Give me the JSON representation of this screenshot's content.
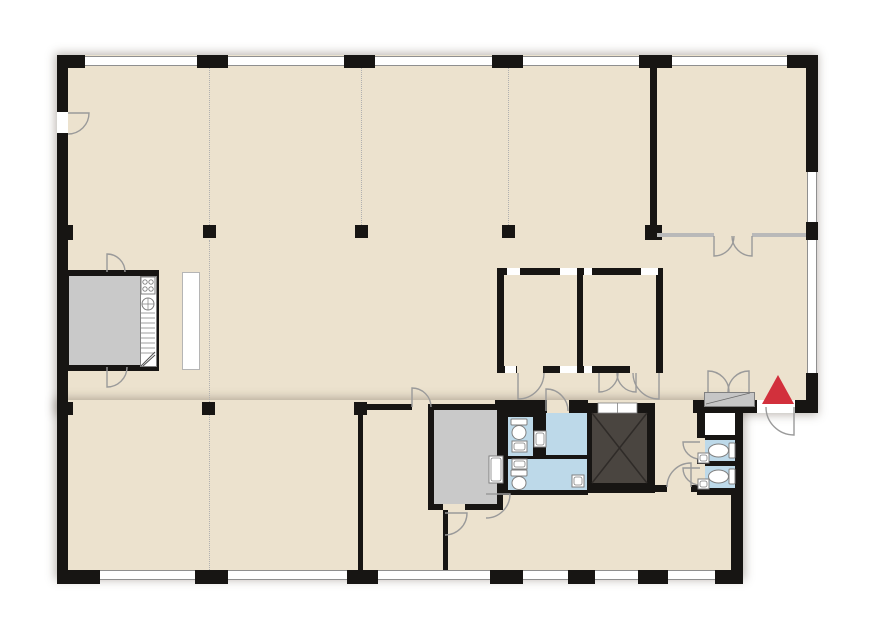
{
  "meta": {
    "description": "Office building floor plan",
    "canvas": {
      "w": 889,
      "h": 617
    }
  },
  "colors": {
    "outside": "#ffffff",
    "floor": "#ece2ce",
    "wall": "#171513",
    "window_line": "#8f8f8f",
    "wet_room": "#bdd9e9",
    "service_room": "#c9c9c9",
    "elevator_cab": "#4a4540",
    "elevator_x": "#2f2b28",
    "cabinet": "#c6c6c6",
    "door_arc": "#9a9a9a",
    "fixture_stroke": "#808080",
    "glass_partition": "#b9b9b9",
    "grid_dotted": "#b0b0b0",
    "entrance_marker": "#d2303c",
    "partition_stroke": "#b5b5b5",
    "white": "#ffffff"
  },
  "slabs": [
    {
      "name": "floor-slab-upper",
      "x": 57,
      "y": 55,
      "w": 759,
      "h": 358
    },
    {
      "name": "floor-slab-lower",
      "x": 57,
      "y": 400,
      "w": 686,
      "h": 178
    }
  ],
  "grid_lines": [
    {
      "name": "column-grid-line",
      "x": 209,
      "y": 68,
      "len": 157
    },
    {
      "name": "column-grid-line",
      "x": 209,
      "y": 240,
      "len": 162
    },
    {
      "name": "column-grid-line",
      "x": 209,
      "y": 415,
      "len": 155
    },
    {
      "name": "column-grid-line",
      "x": 361,
      "y": 68,
      "len": 157
    },
    {
      "name": "column-grid-line",
      "x": 508,
      "y": 68,
      "len": 157
    }
  ],
  "walls": [
    {
      "name": "wall-top-pier",
      "x": 57,
      "y": 55,
      "w": 28,
      "h": 13
    },
    {
      "name": "wall-top-pier",
      "x": 197,
      "y": 55,
      "w": 31,
      "h": 13
    },
    {
      "name": "wall-top-pier",
      "x": 344,
      "y": 55,
      "w": 31,
      "h": 13
    },
    {
      "name": "wall-top-pier",
      "x": 492,
      "y": 55,
      "w": 31,
      "h": 13
    },
    {
      "name": "wall-top-pier",
      "x": 639,
      "y": 55,
      "w": 33,
      "h": 13
    },
    {
      "name": "wall-top-pier",
      "x": 787,
      "y": 55,
      "w": 31,
      "h": 13
    },
    {
      "name": "wall-left",
      "x": 57,
      "y": 55,
      "w": 11,
      "h": 57
    },
    {
      "name": "wall-left",
      "x": 57,
      "y": 133,
      "w": 11,
      "h": 450
    },
    {
      "name": "wall-left-pier",
      "x": 57,
      "y": 225,
      "w": 16,
      "h": 15
    },
    {
      "name": "wall-left-pier",
      "x": 57,
      "y": 402,
      "w": 16,
      "h": 13
    },
    {
      "name": "wall-bottom-pier",
      "x": 57,
      "y": 570,
      "w": 43,
      "h": 14
    },
    {
      "name": "wall-bottom-pier",
      "x": 195,
      "y": 570,
      "w": 33,
      "h": 14
    },
    {
      "name": "wall-bottom-pier",
      "x": 347,
      "y": 570,
      "w": 31,
      "h": 14
    },
    {
      "name": "wall-bottom-pier",
      "x": 490,
      "y": 570,
      "w": 33,
      "h": 14
    },
    {
      "name": "wall-bottom-pier",
      "x": 568,
      "y": 570,
      "w": 27,
      "h": 14
    },
    {
      "name": "wall-bottom-pier",
      "x": 638,
      "y": 570,
      "w": 30,
      "h": 14
    },
    {
      "name": "wall-bottom-pier",
      "x": 715,
      "y": 570,
      "w": 28,
      "h": 14
    },
    {
      "name": "wall-right",
      "x": 806,
      "y": 55,
      "w": 12,
      "h": 117
    },
    {
      "name": "wall-right-pier",
      "x": 806,
      "y": 222,
      "w": 12,
      "h": 18
    },
    {
      "name": "wall-right",
      "x": 806,
      "y": 373,
      "w": 12,
      "h": 40
    },
    {
      "name": "wall-entrance",
      "x": 693,
      "y": 400,
      "w": 64,
      "h": 13
    },
    {
      "name": "wall-entrance",
      "x": 795,
      "y": 400,
      "w": 23,
      "h": 13
    },
    {
      "name": "wall-lower-right",
      "x": 731,
      "y": 413,
      "w": 12,
      "h": 170
    },
    {
      "name": "wall-corner-room",
      "x": 650,
      "y": 68,
      "w": 7,
      "h": 160
    },
    {
      "name": "wall-corner-room-pier",
      "x": 645,
      "y": 225,
      "w": 17,
      "h": 15
    },
    {
      "name": "wall-meeting-top",
      "x": 497,
      "y": 268,
      "w": 166,
      "h": 7
    },
    {
      "name": "wall-meeting-bottom",
      "x": 497,
      "y": 366,
      "w": 166,
      "h": 7
    },
    {
      "name": "wall-meeting-left",
      "x": 497,
      "y": 268,
      "w": 7,
      "h": 105
    },
    {
      "name": "wall-meeting-right",
      "x": 656,
      "y": 268,
      "w": 7,
      "h": 105
    },
    {
      "name": "wall-meeting-divider",
      "x": 577,
      "y": 268,
      "w": 6,
      "h": 105
    },
    {
      "name": "wall-service-room-outline",
      "x": 63,
      "y": 270,
      "w": 96,
      "h": 101
    },
    {
      "name": "wall-storage-room-outline",
      "x": 428,
      "y": 404,
      "w": 75,
      "h": 106
    },
    {
      "name": "wall-sanitary-block",
      "x": 495,
      "y": 400,
      "w": 93,
      "h": 95
    },
    {
      "name": "wall-elevator-shaft",
      "x": 583,
      "y": 403,
      "w": 72,
      "h": 90
    },
    {
      "name": "wall-wc-block-east",
      "x": 697,
      "y": 405,
      "w": 46,
      "h": 90
    },
    {
      "name": "wall-partition-thin",
      "x": 358,
      "y": 404,
      "w": 54,
      "h": 6
    },
    {
      "name": "wall-partition-thin",
      "x": 358,
      "y": 410,
      "w": 5,
      "h": 160
    },
    {
      "name": "wall-partition-thin",
      "x": 443,
      "y": 510,
      "w": 5,
      "h": 60
    },
    {
      "name": "wall-partition-thin",
      "x": 653,
      "y": 485,
      "w": 14,
      "h": 7
    },
    {
      "name": "wall-partition-thin",
      "x": 691,
      "y": 485,
      "w": 9,
      "h": 7
    }
  ],
  "interiors": [
    {
      "name": "room-service-left",
      "x": 69,
      "y": 276,
      "w": 71,
      "h": 89,
      "fill": "service_room"
    },
    {
      "name": "kitchenette-strip",
      "x": 140,
      "y": 276,
      "w": 15,
      "h": 89,
      "fill": "white",
      "stroke": "fixture_stroke"
    },
    {
      "name": "partition-screen",
      "x": 182,
      "y": 272,
      "w": 16,
      "h": 96,
      "fill": "white",
      "stroke": "partition_stroke"
    },
    {
      "name": "room-storage-lower",
      "x": 434,
      "y": 410,
      "w": 63,
      "h": 94,
      "fill": "service_room"
    },
    {
      "name": "glazing-notch",
      "x": 507,
      "y": 268,
      "w": 13,
      "h": 7,
      "fill": "white"
    },
    {
      "name": "glazing-notch",
      "x": 560,
      "y": 268,
      "w": 17,
      "h": 7,
      "fill": "white"
    },
    {
      "name": "glazing-notch",
      "x": 584,
      "y": 268,
      "w": 8,
      "h": 7,
      "fill": "white"
    },
    {
      "name": "glazing-notch",
      "x": 641,
      "y": 268,
      "w": 17,
      "h": 7,
      "fill": "white"
    },
    {
      "name": "glazing-notch",
      "x": 505,
      "y": 366,
      "w": 11,
      "h": 7,
      "fill": "white"
    },
    {
      "name": "glazing-notch",
      "x": 560,
      "y": 366,
      "w": 17,
      "h": 7,
      "fill": "white"
    },
    {
      "name": "glazing-notch",
      "x": 584,
      "y": 366,
      "w": 8,
      "h": 7,
      "fill": "white"
    },
    {
      "name": "room-wc-a",
      "x": 508,
      "y": 417,
      "w": 25,
      "h": 39,
      "fill": "wet_room"
    },
    {
      "name": "room-wc-b",
      "x": 508,
      "y": 459,
      "w": 25,
      "h": 31,
      "fill": "wet_room"
    },
    {
      "name": "room-washroom-a",
      "x": 546,
      "y": 413,
      "w": 41,
      "h": 42,
      "fill": "wet_room"
    },
    {
      "name": "room-washroom-b",
      "x": 532,
      "y": 459,
      "w": 55,
      "h": 31,
      "fill": "wet_room"
    },
    {
      "name": "room-closet-east",
      "x": 705,
      "y": 413,
      "w": 30,
      "h": 22,
      "fill": "white"
    },
    {
      "name": "room-wc-east-a",
      "x": 705,
      "y": 440,
      "w": 30,
      "h": 21,
      "fill": "wet_room"
    },
    {
      "name": "room-wc-east-b",
      "x": 705,
      "y": 466,
      "w": 30,
      "h": 22,
      "fill": "wet_room"
    },
    {
      "name": "elevator-cab",
      "x": 592,
      "y": 413,
      "w": 55,
      "h": 70,
      "fill": "elevator_cab"
    },
    {
      "name": "cabinet-entrance",
      "x": 704,
      "y": 392,
      "w": 49,
      "h": 13,
      "fill": "cabinet",
      "stroke": "fixture_stroke"
    }
  ],
  "windows": [
    {
      "name": "window-top",
      "o": "h",
      "x": 85,
      "y": 56,
      "len": 112
    },
    {
      "name": "window-top",
      "o": "h",
      "x": 228,
      "y": 56,
      "len": 116
    },
    {
      "name": "window-top",
      "o": "h",
      "x": 375,
      "y": 56,
      "len": 117
    },
    {
      "name": "window-top",
      "o": "h",
      "x": 523,
      "y": 56,
      "len": 116
    },
    {
      "name": "window-top",
      "o": "h",
      "x": 672,
      "y": 56,
      "len": 115
    },
    {
      "name": "window-bottom",
      "o": "h",
      "x": 100,
      "y": 570,
      "len": 95
    },
    {
      "name": "window-bottom",
      "o": "h",
      "x": 228,
      "y": 570,
      "len": 119
    },
    {
      "name": "window-bottom",
      "o": "h",
      "x": 378,
      "y": 570,
      "len": 112
    },
    {
      "name": "window-bottom",
      "o": "h",
      "x": 523,
      "y": 570,
      "len": 45
    },
    {
      "name": "window-bottom",
      "o": "h",
      "x": 595,
      "y": 570,
      "len": 43
    },
    {
      "name": "window-bottom",
      "o": "h",
      "x": 668,
      "y": 570,
      "len": 47
    },
    {
      "name": "window-right",
      "o": "v",
      "x": 807,
      "y": 172,
      "len": 50
    },
    {
      "name": "window-right",
      "o": "v",
      "x": 807,
      "y": 240,
      "len": 133
    }
  ],
  "glass_walls": [
    {
      "name": "glass-wall-corner-room",
      "x": 657,
      "y": 233,
      "w": 57,
      "h": 4
    },
    {
      "name": "glass-wall-corner-room",
      "x": 752,
      "y": 233,
      "w": 54,
      "h": 4
    }
  ],
  "gaps": [
    {
      "name": "door-gap-left-entry",
      "x": 57,
      "y": 112,
      "w": 11,
      "h": 21,
      "fill": "white"
    },
    {
      "name": "door-gap-meeting-left",
      "x": 517,
      "y": 366,
      "w": 26,
      "h": 7,
      "fill": "floor"
    },
    {
      "name": "door-gap-meeting-right",
      "x": 630,
      "y": 366,
      "w": 26,
      "h": 7,
      "fill": "floor"
    },
    {
      "name": "door-gap-washroom",
      "x": 547,
      "y": 400,
      "w": 22,
      "h": 13,
      "fill": "floor"
    },
    {
      "name": "door-gap-corridor",
      "x": 667,
      "y": 485,
      "w": 24,
      "h": 7,
      "fill": "floor"
    },
    {
      "name": "door-gap-wc-east-a",
      "x": 697,
      "y": 438,
      "w": 8,
      "h": 21,
      "fill": "floor"
    },
    {
      "name": "door-gap-wc-east-b",
      "x": 697,
      "y": 464,
      "w": 8,
      "h": 21,
      "fill": "floor"
    },
    {
      "name": "door-gap-main-entrance",
      "x": 757,
      "y": 400,
      "w": 38,
      "h": 13,
      "fill": "white"
    },
    {
      "name": "door-gap-storage",
      "x": 443,
      "y": 504,
      "w": 22,
      "h": 6,
      "fill": "floor"
    },
    {
      "name": "door-gap-partition",
      "x": 412,
      "y": 404,
      "w": 16,
      "h": 6,
      "fill": "floor"
    }
  ],
  "columns": [
    {
      "name": "column",
      "x": 203,
      "y": 225
    },
    {
      "name": "column",
      "x": 355,
      "y": 225
    },
    {
      "name": "column",
      "x": 502,
      "y": 225
    },
    {
      "name": "column",
      "x": 202,
      "y": 402
    },
    {
      "name": "column",
      "x": 354,
      "y": 402
    }
  ],
  "doors": [
    {
      "name": "door-left-entry",
      "hx": 68,
      "hy": 113,
      "r": 21,
      "leaf": 0,
      "wall": 90
    },
    {
      "name": "door-service-top",
      "hx": 107,
      "hy": 272,
      "r": 18,
      "leaf": -90,
      "wall": 0
    },
    {
      "name": "door-service-bottom",
      "hx": 107,
      "hy": 367,
      "r": 20,
      "leaf": 90,
      "wall": 0
    },
    {
      "name": "door-meeting-left",
      "hx": 518,
      "hy": 373,
      "r": 26,
      "leaf": 90,
      "wall": 0
    },
    {
      "name": "door-meeting-right",
      "hx": 659,
      "hy": 373,
      "r": 26,
      "leaf": 90,
      "wall": 180
    },
    {
      "name": "door-washroom",
      "hx": 546,
      "hy": 411,
      "r": 22,
      "leaf": -90,
      "wall": 0
    },
    {
      "name": "door-lobby-left",
      "hx": 599,
      "hy": 373,
      "r": 19,
      "leaf": 90,
      "wall": 0
    },
    {
      "name": "door-lobby-right",
      "hx": 636,
      "hy": 373,
      "r": 19,
      "leaf": 90,
      "wall": 180
    },
    {
      "name": "door-corner-room-left",
      "hx": 714,
      "hy": 236,
      "r": 20,
      "leaf": 90,
      "wall": 0
    },
    {
      "name": "door-corner-room-right",
      "hx": 752,
      "hy": 236,
      "r": 20,
      "leaf": 90,
      "wall": 180
    },
    {
      "name": "door-partition",
      "hx": 412,
      "hy": 407,
      "r": 19,
      "leaf": -90,
      "wall": 0
    },
    {
      "name": "door-lower-wall",
      "hx": 445,
      "hy": 513,
      "r": 22,
      "leaf": 0,
      "wall": 90
    },
    {
      "name": "door-south-block",
      "hx": 486,
      "hy": 494,
      "r": 24,
      "leaf": 0,
      "wall": 90
    },
    {
      "name": "door-corridor",
      "hx": 691,
      "hy": 487,
      "r": 24,
      "leaf": -90,
      "wall": 180
    },
    {
      "name": "door-wc-east-a",
      "hx": 700,
      "hy": 442,
      "r": 17,
      "leaf": 180,
      "wall": 90
    },
    {
      "name": "door-wc-east-b",
      "hx": 700,
      "hy": 468,
      "r": 17,
      "leaf": 180,
      "wall": 90
    },
    {
      "name": "door-main-entrance",
      "hx": 794,
      "hy": 407,
      "r": 28,
      "leaf": 90,
      "wall": 180
    },
    {
      "name": "door-cabinet-left",
      "hx": 708,
      "hy": 392,
      "r": 21,
      "leaf": -90,
      "wall": 0
    },
    {
      "name": "door-cabinet-right",
      "hx": 749,
      "hy": 392,
      "r": 21,
      "leaf": -90,
      "wall": 180
    }
  ],
  "fixtures": [
    {
      "type": "stove",
      "name": "stove",
      "x": 141,
      "y": 277,
      "w": 14,
      "h": 17
    },
    {
      "type": "sink_round",
      "name": "sink",
      "cx": 148,
      "cy": 304,
      "r": 6
    },
    {
      "type": "rungs",
      "name": "counter-drawers",
      "x": 141,
      "y": 313,
      "w": 14,
      "h": 40,
      "step": 5
    },
    {
      "type": "zigzag",
      "name": "appliance",
      "x": 141,
      "y": 352,
      "w": 14,
      "h": 14
    },
    {
      "type": "toilet",
      "name": "toilet",
      "x": 511,
      "y": 419,
      "w": 16,
      "h": 21,
      "dir": "s"
    },
    {
      "type": "sink",
      "name": "sink",
      "x": 512,
      "y": 441,
      "w": 15,
      "h": 11
    },
    {
      "type": "sink",
      "name": "sink",
      "x": 512,
      "y": 459,
      "w": 15,
      "h": 10
    },
    {
      "type": "toilet",
      "name": "toilet",
      "x": 511,
      "y": 470,
      "w": 16,
      "h": 20,
      "dir": "s"
    },
    {
      "type": "sink",
      "name": "sink",
      "x": 534,
      "y": 431,
      "w": 12,
      "h": 16
    },
    {
      "type": "sink",
      "name": "sink",
      "x": 572,
      "y": 475,
      "w": 12,
      "h": 12
    },
    {
      "type": "toilet",
      "name": "toilet",
      "x": 708,
      "y": 443,
      "w": 27,
      "h": 15,
      "dir": "w"
    },
    {
      "type": "toilet",
      "name": "toilet",
      "x": 708,
      "y": 469,
      "w": 27,
      "h": 15,
      "dir": "w"
    },
    {
      "type": "sink",
      "name": "sink",
      "x": 698,
      "y": 453,
      "w": 11,
      "h": 10
    },
    {
      "type": "sink",
      "name": "sink",
      "x": 698,
      "y": 479,
      "w": 11,
      "h": 10
    },
    {
      "type": "sink",
      "name": "wash-basin",
      "x": 489,
      "y": 456,
      "w": 14,
      "h": 27
    },
    {
      "type": "xcross",
      "name": "elevator-x",
      "x1": 592,
      "y1": 413,
      "x2": 647,
      "y2": 483
    },
    {
      "type": "elevdoor",
      "name": "elevator-door",
      "x": 598,
      "y": 403,
      "w": 39,
      "h": 10
    },
    {
      "type": "diag",
      "name": "cabinet-line",
      "x1": 706,
      "y1": 404,
      "x2": 750,
      "y2": 393
    }
  ],
  "marker": {
    "name": "entrance-marker",
    "x": 762,
    "y": 375,
    "w": 33,
    "h": 29
  }
}
